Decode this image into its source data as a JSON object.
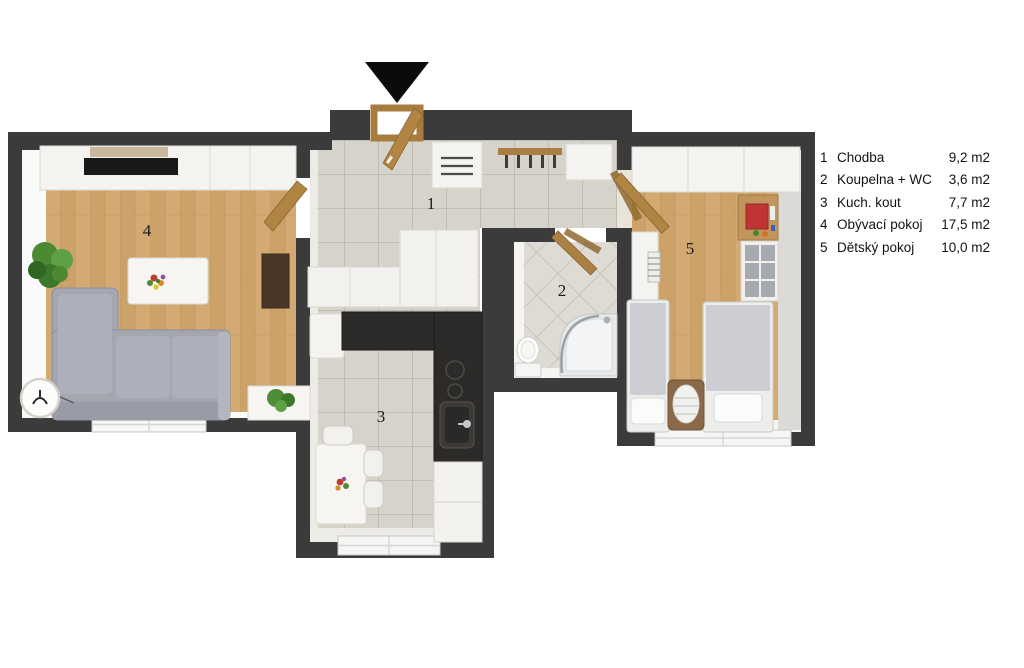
{
  "plan": {
    "entrance_arrow_icon": "entrance-arrow-down",
    "rooms": [
      {
        "label": "1",
        "name": "Chodba"
      },
      {
        "label": "2",
        "name": "Koupelna + WC"
      },
      {
        "label": "3",
        "name": "Kuch. kout"
      },
      {
        "label": "4",
        "name": "Obývací pokoj"
      },
      {
        "label": "5",
        "name": "Dětský pokoj"
      }
    ]
  },
  "legend": {
    "rows": [
      {
        "num": "1",
        "name": "Chodba",
        "area": "9,2 m2"
      },
      {
        "num": "2",
        "name": "Koupelna + WC",
        "area": "3,6 m2"
      },
      {
        "num": "3",
        "name": "Kuch. kout",
        "area": "7,7 m2"
      },
      {
        "num": "4",
        "name": "Obývací pokoj",
        "area": "17,5 m2"
      },
      {
        "num": "5",
        "name": "Dětský pokoj",
        "area": "10,0 m2"
      }
    ]
  },
  "colors": {
    "wall": "#3b3b3b",
    "wood_floor": "#d2a873",
    "tile_floor": "#d6d3cb",
    "bath_tile": "#dedbd4",
    "door_wood": "#ab8045",
    "arrow": "#0b0b0b",
    "sofa": "#a4a6b0",
    "counter_dark": "#2d2b29"
  }
}
